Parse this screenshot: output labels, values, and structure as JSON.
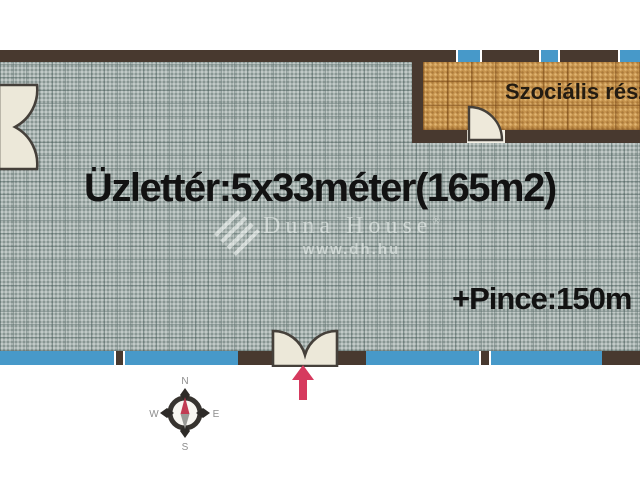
{
  "plan": {
    "title": "Üzlettér:5x33méter(165m2)",
    "basement_label": "+Pince:150m",
    "social_area_label": "Szociális rész",
    "watermark": {
      "brand": "Duna House",
      "mark": "®",
      "url": "www.dh.hu"
    },
    "compass": {
      "north": "N",
      "south": "S",
      "east": "E",
      "west": "W"
    },
    "colors": {
      "wall": "#48392f",
      "window": "#4799c9",
      "shop_floor": "#a9b4b1",
      "social_floor": "#c6944e",
      "door": "#eae5d4",
      "entrance_arrow": "#d63a5e",
      "compass_needle_north": "#c13b52"
    }
  }
}
